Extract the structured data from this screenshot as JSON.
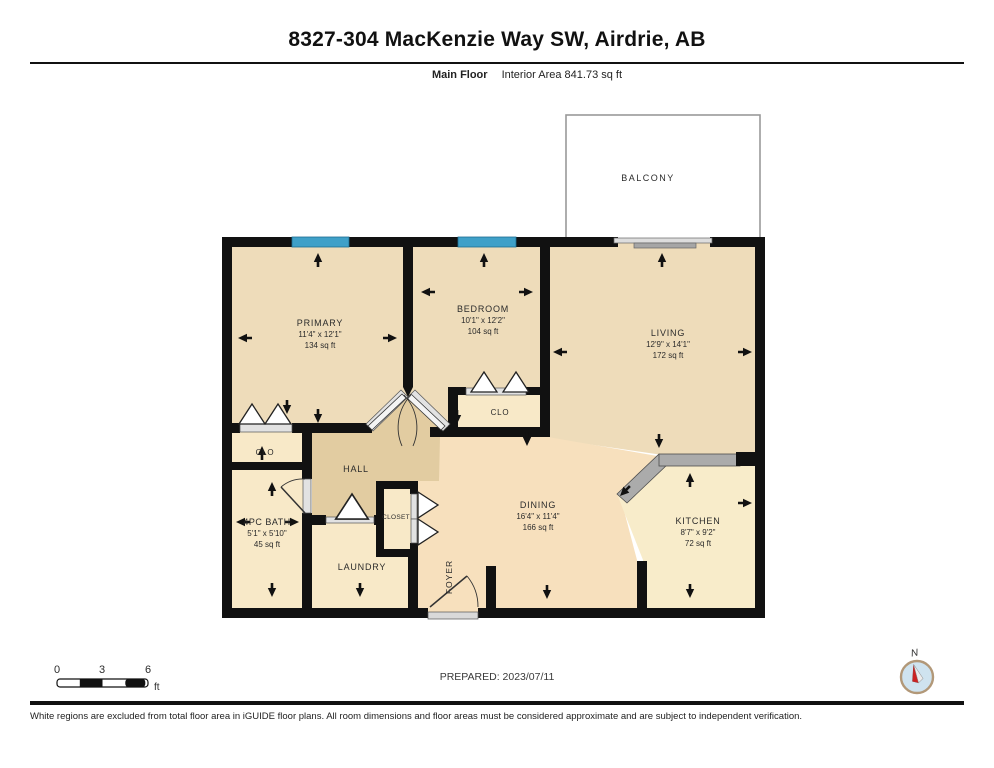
{
  "header": {
    "title": "8327-304 MacKenzie Way SW, Airdrie, AB",
    "floor_label": "Main Floor",
    "interior_area_label": "Interior Area 841.73 sq ft"
  },
  "plan": {
    "balcony_label": "BALCONY",
    "rooms": {
      "primary": {
        "name": "PRIMARY",
        "dims": "11'4\" x 12'1\"",
        "area": "134 sq ft"
      },
      "bedroom": {
        "name": "BEDROOM",
        "dims": "10'1\" x 12'2\"",
        "area": "104 sq ft"
      },
      "living": {
        "name": "LIVING",
        "dims": "12'9\" x 14'1\"",
        "area": "172 sq ft"
      },
      "dining": {
        "name": "DINING",
        "dims": "16'4\" x 11'4\"",
        "area": "166 sq ft"
      },
      "kitchen": {
        "name": "KITCHEN",
        "dims": "8'7\" x 9'2\"",
        "area": "72 sq ft"
      },
      "bath": {
        "name": "4PC BATH",
        "dims": "5'1\" x 5'10\"",
        "area": "45 sq ft"
      }
    },
    "labels": {
      "hall": "HALL",
      "laundry": "LAUNDRY",
      "foyer": "FOYER",
      "closet": "CLOSET",
      "clo_primary": "CLO",
      "clo_bedroom": "CLO"
    }
  },
  "scale_bar": {
    "ticks": [
      "0",
      "3",
      "6"
    ],
    "unit": "ft"
  },
  "prepared_label": "PREPARED: 2023/07/11",
  "compass": {
    "north_label": "N"
  },
  "footer": {
    "disclaimer": "White regions are excluded from total floor area in iGUIDE floor plans. All room dimensions and floor areas must be considered approximate and are subject to independent verification."
  },
  "colors": {
    "wall": "#111111",
    "window_blue": "#3fa0c8",
    "room_tan": "#eedcba",
    "room_peach": "#f7e0bd",
    "room_cream": "#f8e9c8",
    "kitchen_cream": "#f8ecca",
    "hall_tan": "#e2cca1",
    "counter_gray": "#ababab",
    "compass_red": "#cc2222"
  }
}
